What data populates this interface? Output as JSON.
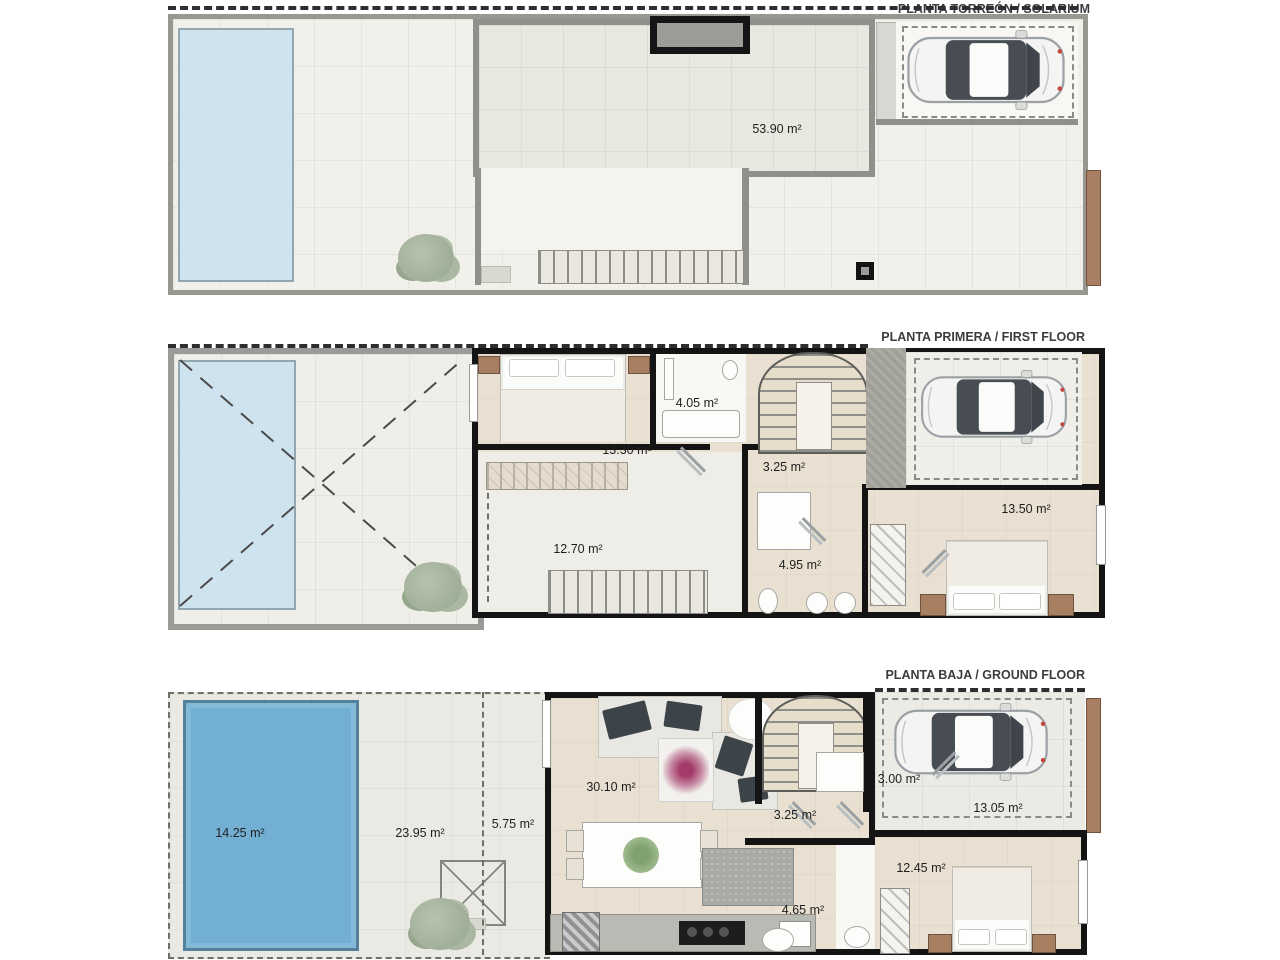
{
  "document": {
    "type": "floor-plan-sheet",
    "unit": "m²"
  },
  "colors": {
    "pool_light": "#cfe3ef",
    "pool_deep": "#72afd3",
    "wall_black": "#141414",
    "wall_gray": "#8f8f8c",
    "floor_tile": "#f1f0ea",
    "floor_beige": "#e9e0d1",
    "wood_brown": "#a87f60",
    "plant_green": "#a9b6a2",
    "flower_magenta": "#a43a6a"
  },
  "plans": [
    {
      "id": "solarium",
      "title": "PLANTA TORREÓN / SOLARIUM",
      "rooms": [
        {
          "name": "solarium-terrace",
          "area": "53.90 m²"
        }
      ]
    },
    {
      "id": "first-floor",
      "title": "PLANTA PRIMERA / FIRST FLOOR",
      "rooms": [
        {
          "name": "bathroom",
          "area": "4.05 m²"
        },
        {
          "name": "master-bedroom",
          "area": "13.30 m²"
        },
        {
          "name": "landing",
          "area": "3.25 m²"
        },
        {
          "name": "terrace",
          "area": "12.70 m²"
        },
        {
          "name": "bathroom-2",
          "area": "4.95 m²"
        },
        {
          "name": "bedroom-2",
          "area": "13.50 m²"
        }
      ]
    },
    {
      "id": "ground-floor",
      "title": "PLANTA BAJA / GROUND FLOOR",
      "rooms": [
        {
          "name": "pool",
          "area": "14.25 m²"
        },
        {
          "name": "garden",
          "area": "23.95 m²"
        },
        {
          "name": "porch",
          "area": "5.75 m²"
        },
        {
          "name": "living-dining",
          "area": "30.10 m²"
        },
        {
          "name": "hallway",
          "area": "3.25 m²"
        },
        {
          "name": "entry",
          "area": "3.00 m²"
        },
        {
          "name": "carport",
          "area": "13.05 m²"
        },
        {
          "name": "bathroom",
          "area": "4.65 m²"
        },
        {
          "name": "bedroom",
          "area": "12.45 m²"
        }
      ]
    }
  ]
}
